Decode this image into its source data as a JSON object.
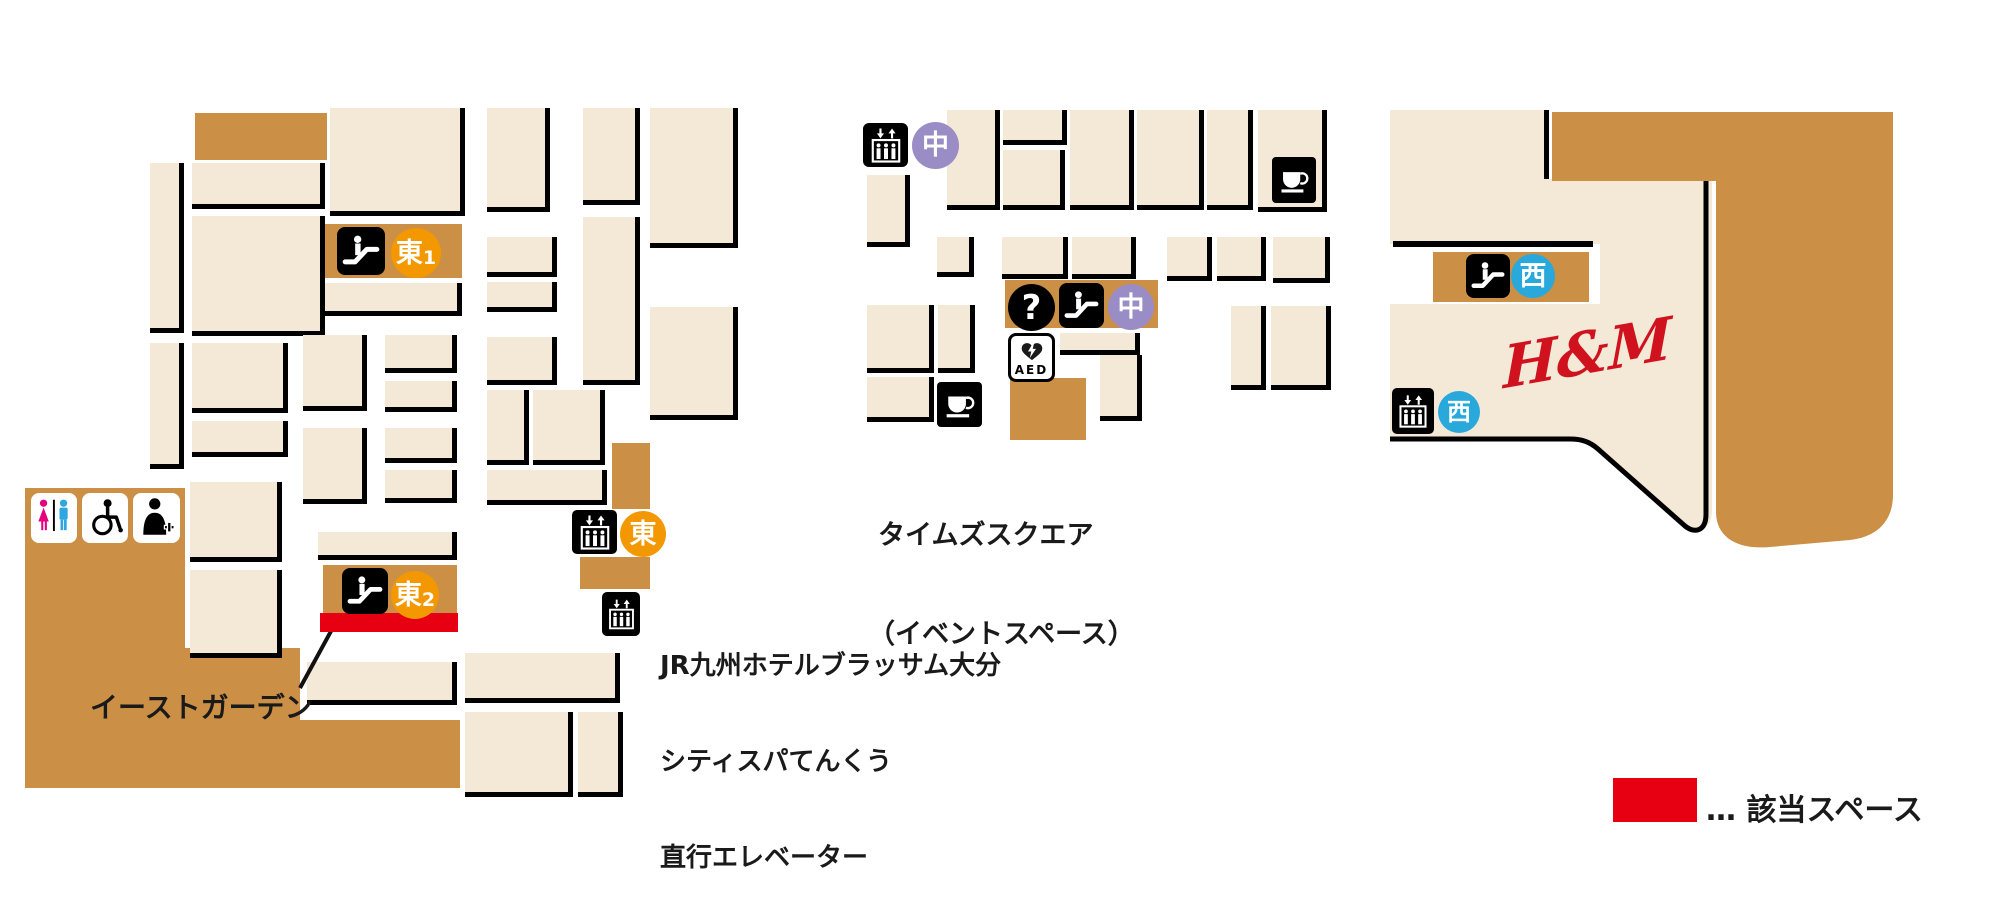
{
  "colors": {
    "beige": "#f4e8d6",
    "brown": "#cb9046",
    "black": "#000000",
    "red": "#e60012",
    "orange": "#f39800",
    "purple": "#9a8cc5",
    "blue": "#29a8dc",
    "hm_red": "#d0121f",
    "pink": "#e4007f",
    "man_blue": "#2ea7e0",
    "white": "#ffffff"
  },
  "labels": {
    "east_garden": "イーストガーデン",
    "times_square_line1": "タイムズスクエア",
    "times_square_line2": "（イベントスペース）",
    "hotel_line1": "JR九州ホテルブラッサム大分",
    "hotel_line2": "シティスパてんくう",
    "hotel_line3": "直行エレベーター",
    "hm_logo": "H&M",
    "aed": "AED",
    "question_mark": "?"
  },
  "legend": {
    "label": "… 該当スペース",
    "swatch_color": "#e60012"
  },
  "badges": {
    "east1": {
      "text": "東",
      "sub": "1",
      "color": "#f39800"
    },
    "east2": {
      "text": "東",
      "sub": "2",
      "color": "#f39800"
    },
    "east_elevator": {
      "text": "東",
      "color": "#f39800"
    },
    "center_elevator": {
      "text": "中",
      "color": "#9a8cc5"
    },
    "center_escalator": {
      "text": "中",
      "color": "#9a8cc5"
    },
    "west_escalator": {
      "text": "西",
      "color": "#29a8dc"
    },
    "west_elevator": {
      "text": "西",
      "color": "#29a8dc"
    }
  },
  "icons": {
    "escalator": "escalator-icon",
    "elevator": "elevator-icon",
    "restroom": "restroom-icon",
    "wheelchair": "wheelchair-icon",
    "nursing_room": "nursing-room-icon",
    "information": "question-icon",
    "aed": "aed-icon",
    "cafe": "coffee-icon"
  }
}
